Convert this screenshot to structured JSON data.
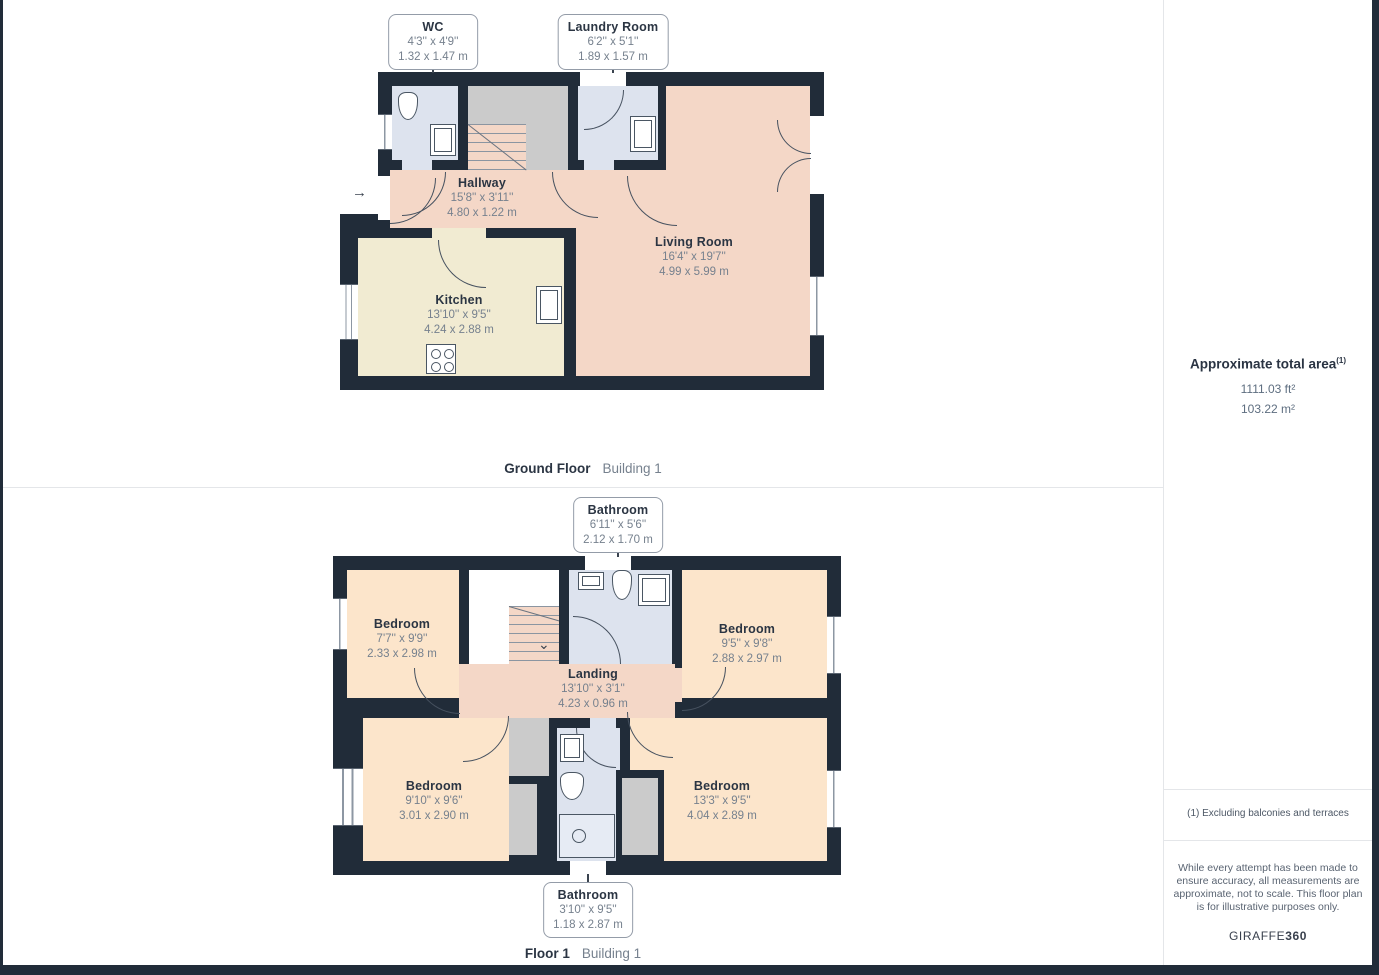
{
  "floors": [
    {
      "caption": "Ground Floor",
      "building": "Building 1",
      "callouts": [
        {
          "name": "WC",
          "dims_ft": "4'3'' x 4'9''",
          "dims_m": "1.32 x 1.47 m"
        },
        {
          "name": "Laundry Room",
          "dims_ft": "6'2'' x 5'1''",
          "dims_m": "1.89 x 1.57 m"
        }
      ],
      "rooms": [
        {
          "name": "Hallway",
          "dims_ft": "15'8'' x 3'11''",
          "dims_m": "4.80 x 1.22 m"
        },
        {
          "name": "Living Room",
          "dims_ft": "16'4'' x 19'7''",
          "dims_m": "4.99 x 5.99 m"
        },
        {
          "name": "Kitchen",
          "dims_ft": "13'10'' x 9'5''",
          "dims_m": "4.24 x 2.88 m"
        }
      ]
    },
    {
      "caption": "Floor 1",
      "building": "Building 1",
      "callouts": [
        {
          "name": "Bathroom",
          "dims_ft": "6'11'' x 5'6''",
          "dims_m": "2.12 x 1.70 m"
        },
        {
          "name": "Bathroom",
          "dims_ft": "3'10'' x 9'5''",
          "dims_m": "1.18 x 2.87 m"
        }
      ],
      "rooms": [
        {
          "name": "Bedroom",
          "dims_ft": "7'7'' x 9'9''",
          "dims_m": "2.33 x 2.98 m"
        },
        {
          "name": "Bedroom",
          "dims_ft": "9'5'' x 9'8''",
          "dims_m": "2.88 x 2.97 m"
        },
        {
          "name": "Landing",
          "dims_ft": "13'10'' x 3'1''",
          "dims_m": "4.23 x 0.96 m"
        },
        {
          "name": "Bedroom",
          "dims_ft": "9'10'' x 9'6''",
          "dims_m": "3.01 x 2.90 m"
        },
        {
          "name": "Bedroom",
          "dims_ft": "13'3'' x 9'5''",
          "dims_m": "4.04 x 2.89 m"
        }
      ]
    }
  ],
  "sidebar": {
    "title": "Approximate total area",
    "title_sup": "(1)",
    "area_ft": "1111.03 ft²",
    "area_m": "103.22 m²",
    "footnote": "(1) Excluding balconies and terraces",
    "disclaimer": "While every attempt has been made to ensure accuracy, all measurements are approximate, not to scale. This floor plan is for illustrative purposes only.",
    "brand_normal": "GIRAFFE",
    "brand_bold": "360"
  },
  "icons": {
    "entry_arrow": "→",
    "stair_down_arrow": "⌄"
  },
  "colors": {
    "wall": "#212c39",
    "living_hallway_landing": "#f4d7c7",
    "kitchen": "#f1ebd2",
    "wet_rooms": "#dde3ee",
    "bedrooms": "#fce5cb",
    "stairs_gray": "#cbcbcb",
    "label_title": "#2b3543",
    "label_dims": "#76818e"
  }
}
